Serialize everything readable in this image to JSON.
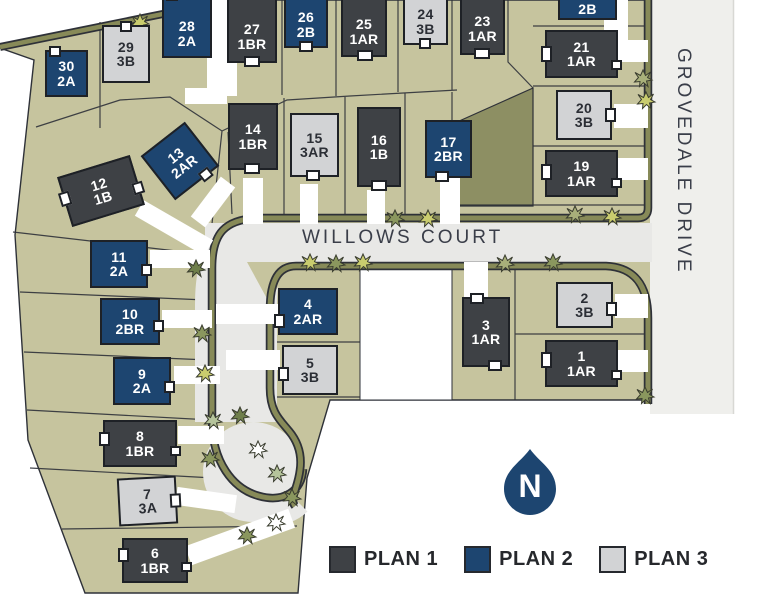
{
  "map": {
    "streets": {
      "willows": "WILLOWS COURT",
      "grovedale": "GROVEDALE DRIVE"
    },
    "north_label": "N",
    "legend": [
      {
        "label": "PLAN 1",
        "color": "#3e4145"
      },
      {
        "label": "PLAN 2",
        "color": "#1d4570"
      },
      {
        "label": "PLAN 3",
        "color": "#d2d3d5"
      }
    ],
    "plan_colors": {
      "1": "#3e4145",
      "2": "#1d4570",
      "3": "#d2d3d5"
    },
    "lots": [
      {
        "number": "1",
        "plan": "1AR"
      },
      {
        "number": "2",
        "plan": "3B"
      },
      {
        "number": "3",
        "plan": "1AR"
      },
      {
        "number": "4",
        "plan": "2AR"
      },
      {
        "number": "5",
        "plan": "3B"
      },
      {
        "number": "6",
        "plan": "1BR"
      },
      {
        "number": "7",
        "plan": "3A"
      },
      {
        "number": "8",
        "plan": "1BR"
      },
      {
        "number": "9",
        "plan": "2A"
      },
      {
        "number": "10",
        "plan": "2BR"
      },
      {
        "number": "11",
        "plan": "2A"
      },
      {
        "number": "12",
        "plan": "1B"
      },
      {
        "number": "13",
        "plan": "2AR"
      },
      {
        "number": "14",
        "plan": "1BR"
      },
      {
        "number": "15",
        "plan": "3AR"
      },
      {
        "number": "16",
        "plan": "1B"
      },
      {
        "number": "17",
        "plan": "2BR"
      },
      {
        "number": "19",
        "plan": "1AR"
      },
      {
        "number": "20",
        "plan": "3B"
      },
      {
        "number": "21",
        "plan": "1AR"
      },
      {
        "number": "",
        "plan": "2B"
      },
      {
        "number": "23",
        "plan": "1AR"
      },
      {
        "number": "24",
        "plan": "3B"
      },
      {
        "number": "25",
        "plan": "1AR"
      },
      {
        "number": "26",
        "plan": "2B"
      },
      {
        "number": "27",
        "plan": "1BR"
      },
      {
        "number": "28",
        "plan": "2A"
      },
      {
        "number": "29",
        "plan": "3B"
      },
      {
        "number": "30",
        "plan": "2A"
      }
    ]
  }
}
